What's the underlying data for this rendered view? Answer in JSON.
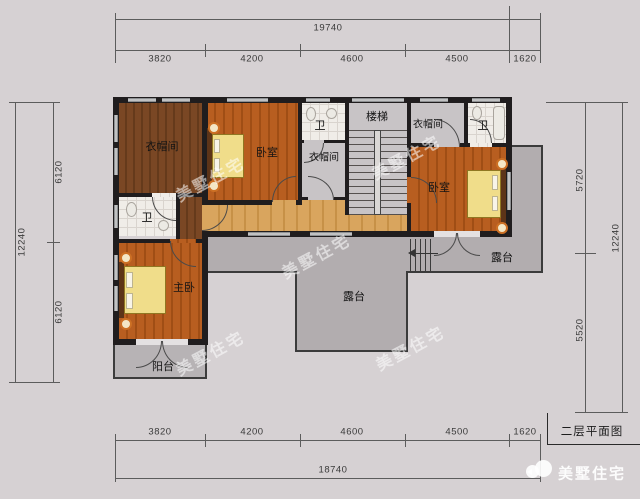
{
  "title": "二层平面图",
  "brand": "美墅住宅",
  "watermark_text": "美墅住宅",
  "dimensions": {
    "top": {
      "total": "19740",
      "segments": [
        "3820",
        "4200",
        "4600",
        "4500",
        "1620"
      ]
    },
    "bottom": {
      "total": "18740",
      "segments": [
        "3820",
        "4200",
        "4600",
        "4500",
        "1620"
      ]
    },
    "left": {
      "total": "12240",
      "segments": [
        "6120",
        "6120"
      ]
    },
    "right": {
      "total": "12240",
      "segments": [
        "5720",
        "5520"
      ]
    }
  },
  "rooms": {
    "cloakroom_left": "衣帽间",
    "bath_left": "卫",
    "bedroom_top": "卧室",
    "bath_mid": "卫",
    "cloakroom_mid": "衣帽间",
    "stairs": "楼梯",
    "cloakroom_right": "衣帽间",
    "bath_right": "卫",
    "bedroom_right": "卧室",
    "master_bedroom": "主卧",
    "balcony": "阳台",
    "terrace_main": "露台",
    "terrace_right": "露台"
  },
  "colors": {
    "background": "#d6d1d3",
    "wall": "#201d1e",
    "wood_orange": "#b05a1d",
    "wood_dark": "#73411f",
    "wood_light": "#d8a45c",
    "floor_grey": "#c8c4c6",
    "tile": "#f0ede8",
    "terrace": "#b2adaf",
    "bed": "#f0dd8a",
    "lamp_ring": "#cc7024"
  }
}
